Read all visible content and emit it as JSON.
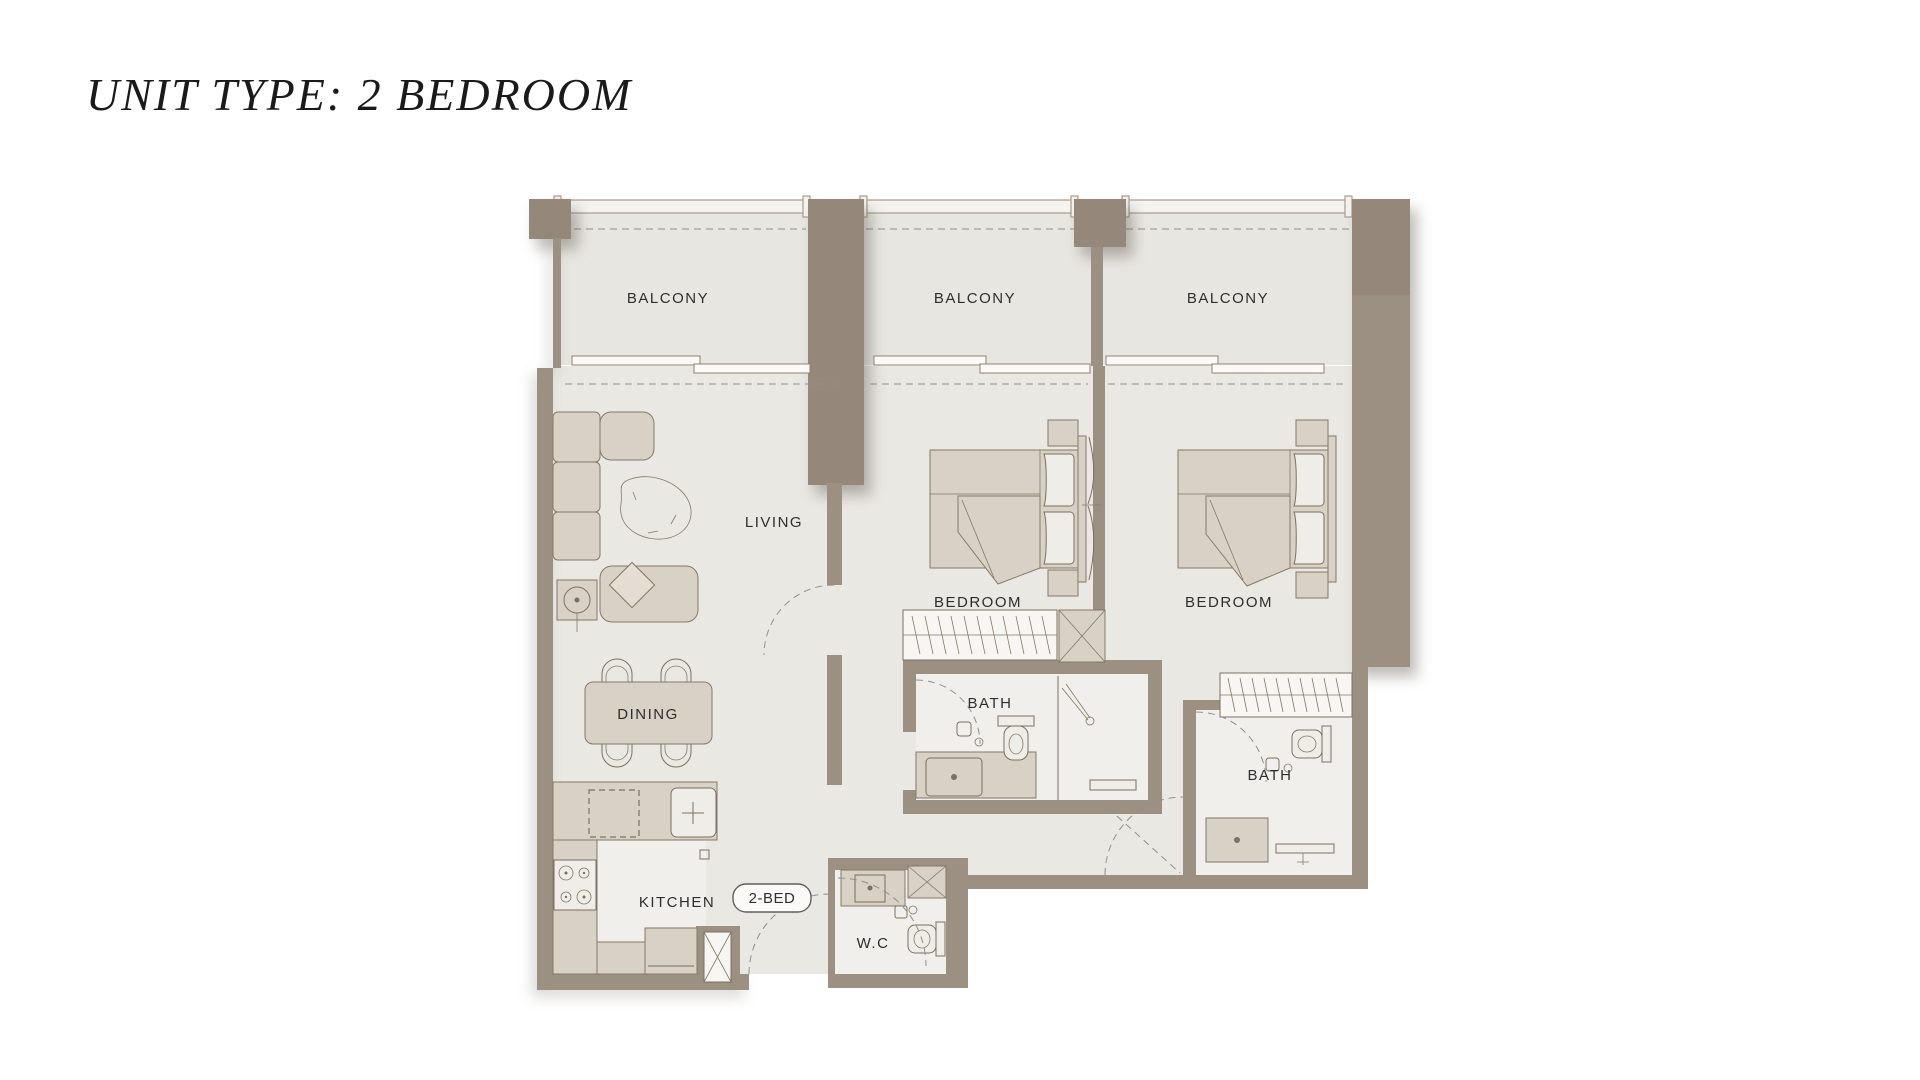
{
  "page": {
    "title": "UNIT TYPE: 2 BEDROOM"
  },
  "plan": {
    "unit_badge": "2-BED",
    "labels": {
      "balcony1": "BALCONY",
      "balcony2": "BALCONY",
      "balcony3": "BALCONY",
      "living": "LIVING",
      "dining": "DINING",
      "kitchen": "KITCHEN",
      "bedroom1": "BEDROOM",
      "bedroom2": "BEDROOM",
      "bath1": "BATH",
      "bath2": "BATH",
      "wc": "W.C"
    },
    "colors": {
      "wall": "#9c9082",
      "wall_dark": "#95887a",
      "floor": "#eae8e3",
      "floor_light": "#f0efeb",
      "furniture": "#d8d1c5",
      "outline": "#857968",
      "label_text": "#2e2e2e",
      "title_text": "#1a1a1a"
    }
  }
}
